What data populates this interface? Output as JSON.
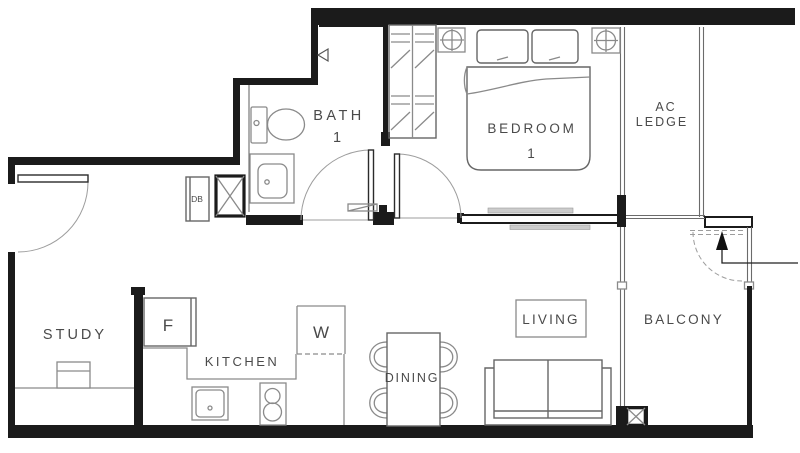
{
  "rooms": {
    "study": "STUDY",
    "kitchen": "KITCHEN",
    "dining": "DINING",
    "living": "LIVING",
    "balcony": "BALCONY",
    "bedroom": {
      "line1": "BEDROOM",
      "line2": "1"
    },
    "bath": {
      "line1": "BATH",
      "line2": "1"
    },
    "ac_ledge": {
      "line1": "AC",
      "line2": "LEDGE"
    }
  },
  "appliances": {
    "fridge": "F",
    "washer": "W",
    "distribution_board": "DB"
  },
  "colors": {
    "wall": "#1b1b1b",
    "fixture_line": "#8a8a8a",
    "label_text": "#4a4a4a",
    "window_gray": "#cccccc",
    "background": "#ffffff"
  }
}
